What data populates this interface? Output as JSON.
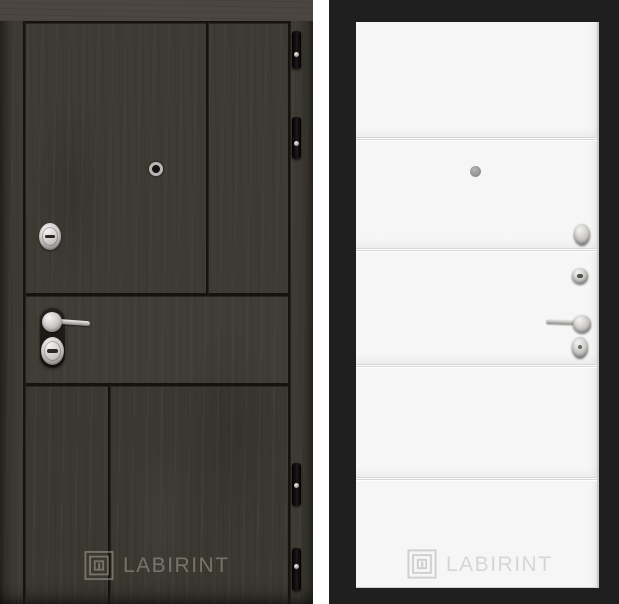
{
  "brand": "LABIRINT",
  "left_door": {
    "description": "dark wenge wood entry door leaf",
    "logo_text": "LABIRINT",
    "hardware": [
      "peephole",
      "upper-cylinder-lock",
      "lever-handle",
      "lower-cylinder-lock",
      "hinges"
    ]
  },
  "right_door": {
    "description": "white interior door panel with horizontal moldings in black frame",
    "logo_text": "LABIRINT",
    "hardware": [
      "peephole",
      "turn-knob",
      "round-cylinder-lock",
      "lever-handle",
      "oval-escutcheon"
    ]
  },
  "colors": {
    "background": "#ffffff",
    "wood_panel": "#3e3a34",
    "wood_top": "#4b463f",
    "wood_groove": "#16130f",
    "chrome": "#c7c5c2",
    "frame_black": "#1f1f1f",
    "leaf_white": "#f6f6f6",
    "leaf_groove": "#d7d7d7",
    "logo_dark_door": "rgba(202,197,187,0.42)",
    "logo_white_door": "#d6d6d6"
  }
}
